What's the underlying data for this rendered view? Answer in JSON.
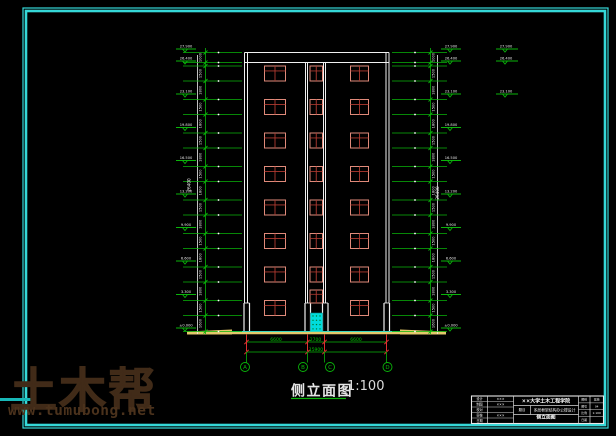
{
  "sheet": {
    "background": "#000000",
    "border_color": "#35d8d8",
    "line_color": "#f0f0f0",
    "green": "#0ab40a",
    "dim_text_green": "#00c800",
    "red": "#e03030",
    "window_frame": "#e08a7a",
    "window_mullion": "#b03a30",
    "door_color": "#00dcdc",
    "ground_yellow": "#e3c96a"
  },
  "drawing": {
    "title": "侧立面图",
    "scale": "1:100",
    "axis_labels": [
      "A",
      "B",
      "C",
      "D"
    ],
    "bottom_dims": {
      "segments": [
        "6600",
        "2700",
        "6600"
      ],
      "total": "15900"
    },
    "elevations": [
      "27.900",
      "26.400",
      "23.100",
      "19.800",
      "16.500",
      "13.200",
      "9.900",
      "6.600",
      "3.300",
      "±0.000"
    ],
    "outboard_elevations": [
      "27.900",
      "26.400",
      "23.100"
    ],
    "overall_height_dim": "26400",
    "chain_dim_small": "1000",
    "chain_dim_window": "1500",
    "chain_dim_spandrel": "1800",
    "chain_dim_base": "1600"
  },
  "geometry": {
    "border_outer": [
      23,
      8,
      585,
      420
    ],
    "border_inner": [
      26,
      11,
      579,
      414
    ],
    "building": {
      "outer_left": 244.5,
      "inner_left": 247.5,
      "inner_right": 386,
      "outer_right": 389,
      "parapet_top": 52.5,
      "parapet_bot": 62.5,
      "wall_bottom": 303,
      "shaft_lines": [
        305.5,
        307.5,
        323.5,
        325.5
      ],
      "base_pairs": [
        [
          244,
          249.5
        ],
        [
          305,
          310.5
        ],
        [
          322.5,
          328
        ],
        [
          384,
          389.5
        ]
      ],
      "ground_y": 331.5,
      "window_rows": [
        66,
        99.5,
        133,
        166.5,
        200,
        233.5,
        267,
        300.5
      ],
      "window_h": 15,
      "col_left": {
        "x": 264.5,
        "w": 21
      },
      "col_mid": {
        "x": 310,
        "w": 12.5
      },
      "col_right": {
        "x": 350.5,
        "w": 18
      },
      "mid_rows_aligned": 7,
      "mid_offset_window": {
        "x": 310,
        "y": 290,
        "w": 12.5,
        "h": 13
      },
      "door": {
        "x": 310.5,
        "y": 313,
        "w": 12,
        "h": 18.5
      }
    },
    "ground": {
      "cyan_x": [
        232,
        400
      ],
      "yellow_x": [
        187,
        446
      ]
    },
    "chains": {
      "left": {
        "white_x": 197.5,
        "green_x": 205.5,
        "comb_x1": 183,
        "comb_x2": 242,
        "dot_x": 218.5,
        "text_x": 201.5
      },
      "right": {
        "white_x": 437.5,
        "green_x": 430.5,
        "comb_x1": 392,
        "comb_x2": 447,
        "dot_x": 415,
        "text_x": 434.5
      }
    },
    "flags": {
      "ys": [
        49,
        61,
        94,
        127.5,
        160.5,
        194,
        227.5,
        261,
        294.5,
        328
      ],
      "left": {
        "x1": 176,
        "x2": 196
      },
      "right": {
        "x1": 441,
        "x2": 461
      },
      "outboard": {
        "x1": 496,
        "x2": 518,
        "ys": [
          49,
          61,
          94
        ]
      }
    },
    "overall_dim_text_pos": {
      "left": [
        190.5,
        185
      ],
      "right": [
        439,
        193
      ]
    },
    "dims": {
      "ext_x": [
        246.5,
        307.5,
        324.5,
        386.5
      ],
      "y1": 342,
      "y2": 352,
      "axis_x": [
        245,
        303,
        330,
        387.5
      ],
      "stem_y2": 362.5,
      "bubble_cy": 367,
      "bubble_r": 4.5,
      "seg_text_x": [
        276,
        315.5,
        356
      ],
      "total_text_x": 316
    },
    "title_pos": {
      "text": [
        291,
        395.5
      ],
      "scale": [
        347,
        390
      ],
      "underline": [
        291,
        346,
        398.5
      ]
    },
    "title_block": {
      "x": 471.5,
      "y": 396,
      "w": 132,
      "h": 27.5
    }
  },
  "title_block": {
    "left_rows": [
      {
        "label": "设计",
        "value": "×××"
      },
      {
        "label": "制图",
        "value": "×××"
      },
      {
        "label": "校对",
        "value": ""
      },
      {
        "label": "审核",
        "value": "×××"
      },
      {
        "label": "日期",
        "value": ""
      }
    ],
    "institution": "××大学土木工程学院",
    "subject_label": "题目",
    "subject": "多层框架结构办公楼设计",
    "drawing_name": "侧立面图",
    "right_rows": [
      {
        "label": "图别",
        "value": "建施"
      },
      {
        "label": "图号",
        "value": "04"
      },
      {
        "label": "比例",
        "value": "1:100"
      },
      {
        "label": "日期",
        "value": ""
      }
    ]
  },
  "watermark": {
    "logo": "土木帮",
    "url": "www.tumubong.net"
  }
}
